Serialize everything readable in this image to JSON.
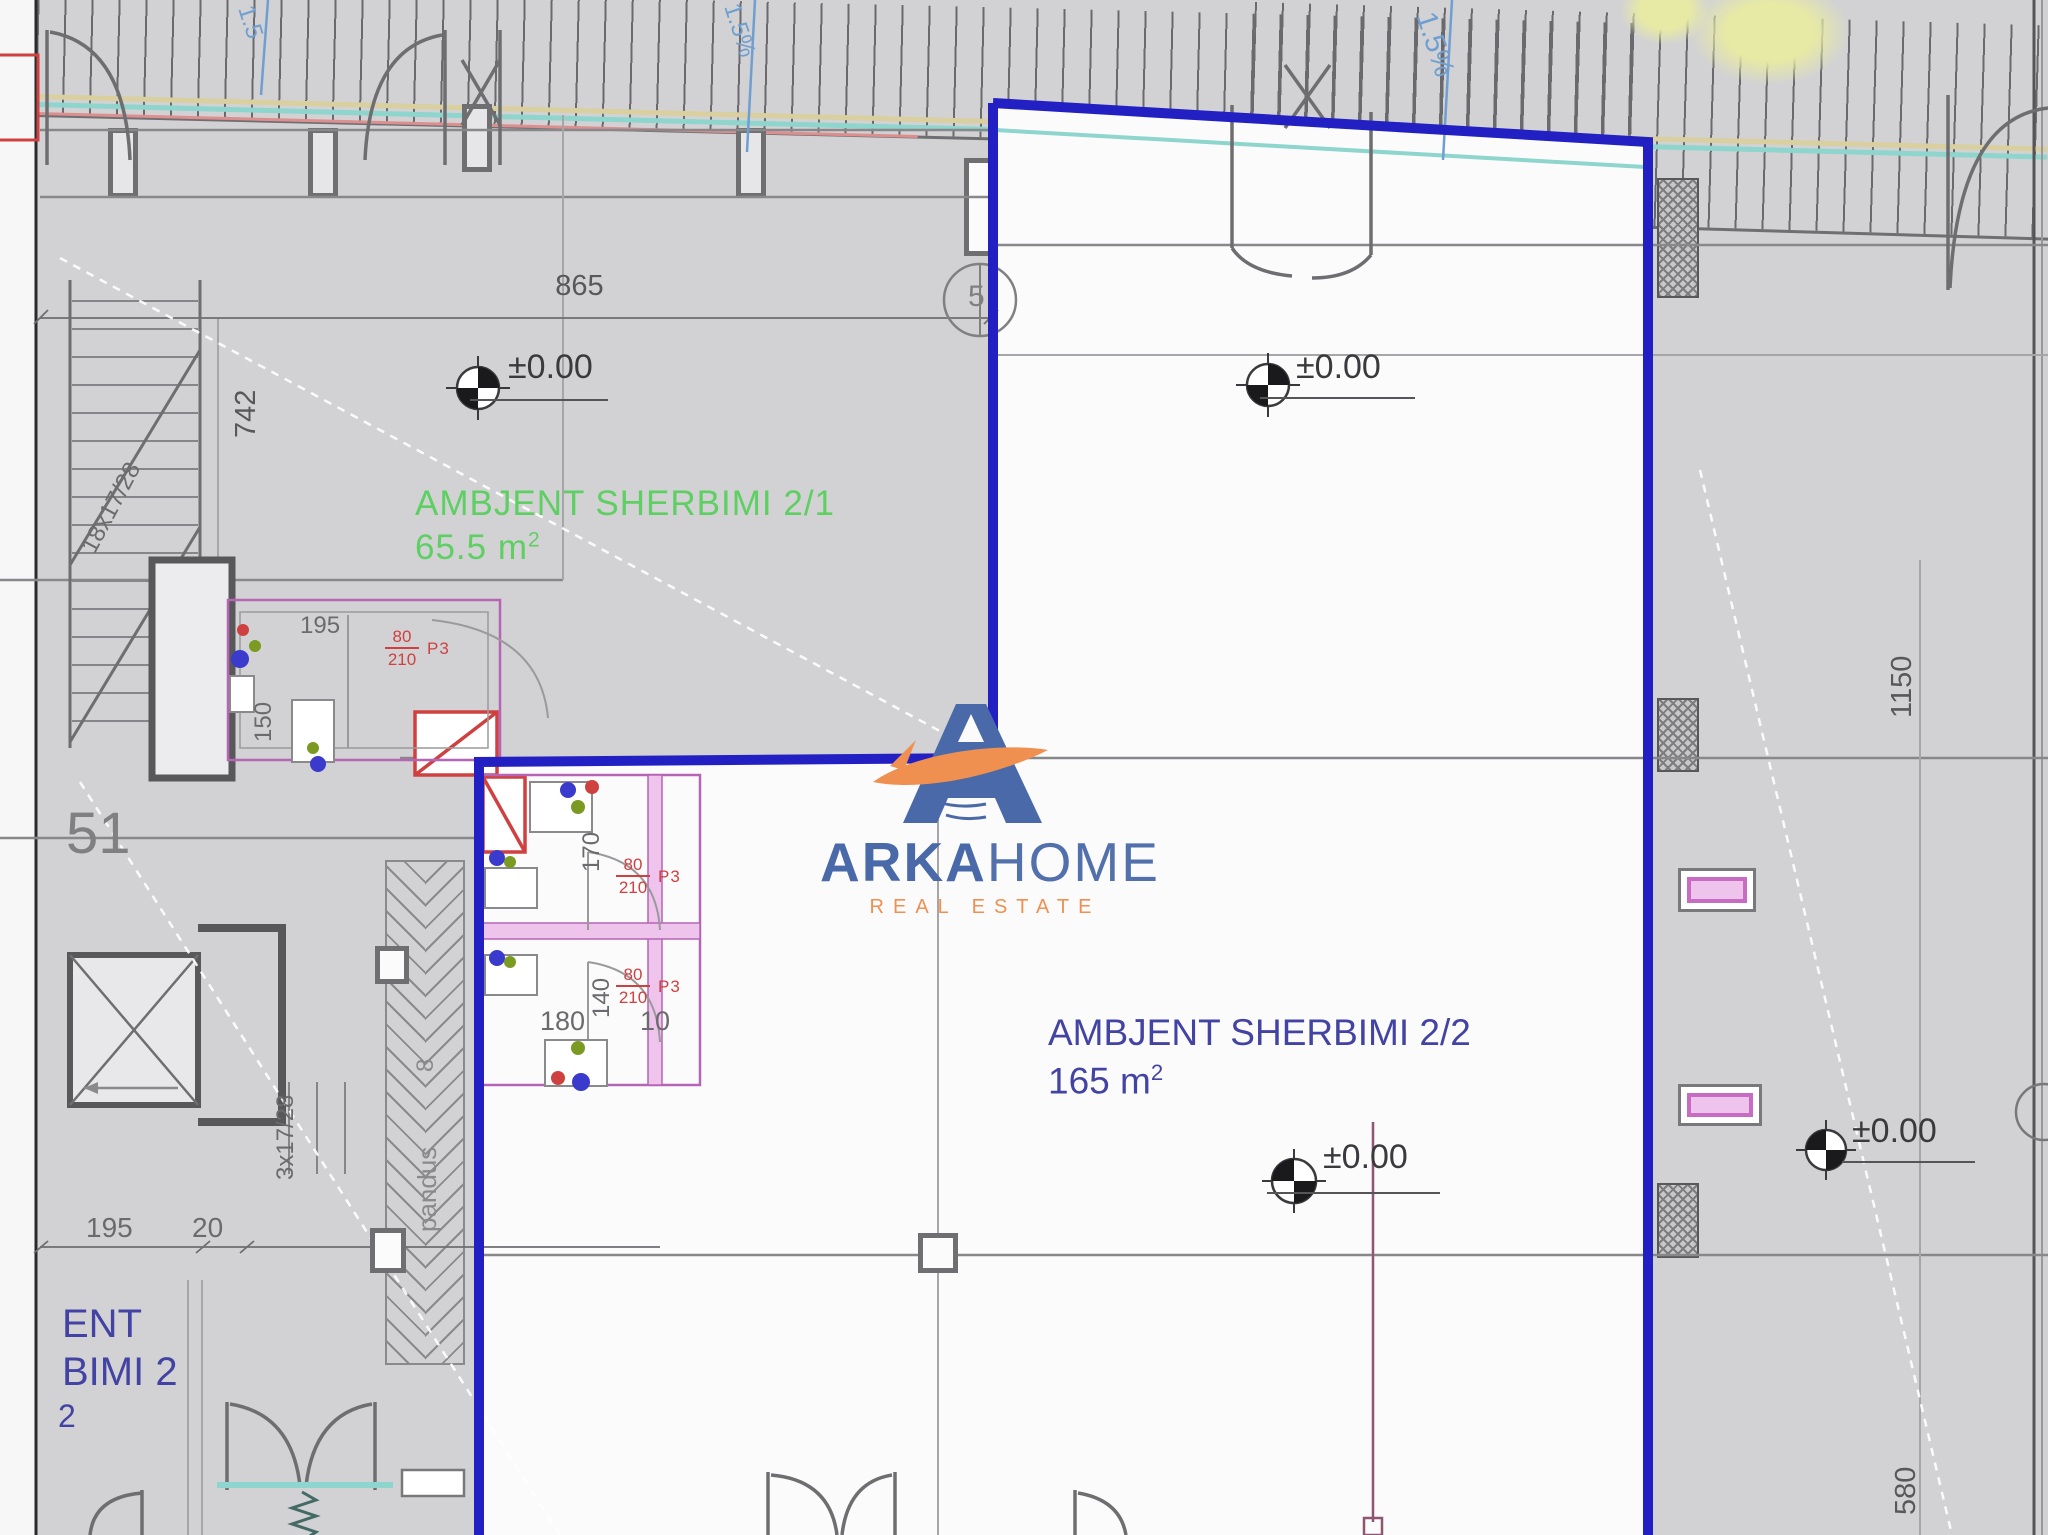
{
  "plan": {
    "unit_2_1": {
      "label": "AMBJENT SHERBIMI  2/1",
      "area": "65.5 m",
      "area_sup": "2"
    },
    "unit_2_2": {
      "label": "AMBJENT SHERBIMI 2/2",
      "area": "165 m",
      "area_sup": "2"
    },
    "adjacent_unit": {
      "line1": "ENT",
      "line2": "BIMI 2",
      "line3": "2"
    },
    "elevation_label": "±0.00",
    "dims": {
      "top_width": "865",
      "left_height": "742",
      "right_height": "1150",
      "bottom_right": "580",
      "bath_width": "195",
      "bath_height": "150",
      "bath2_height": "170",
      "bath2_mid": "140",
      "bath2_width": "180",
      "bath2_offset": "10",
      "bottom_left_a": "195",
      "bottom_left_b": "20"
    },
    "stairs": {
      "upper": "18x17/28",
      "lower": "3x17/28"
    },
    "ramp": {
      "label": "pandus",
      "number": "8"
    },
    "grid": {
      "left_label": "51",
      "bubble": "5"
    },
    "slopes": {
      "s1": "1.5",
      "s2": "1.5%",
      "s3": "1.5%"
    },
    "door_tag": {
      "w": "80",
      "h": "210",
      "name": "P3"
    }
  },
  "watermark": {
    "arka": "ARKA",
    "home": "HOME",
    "sub": "REAL ESTATE"
  }
}
